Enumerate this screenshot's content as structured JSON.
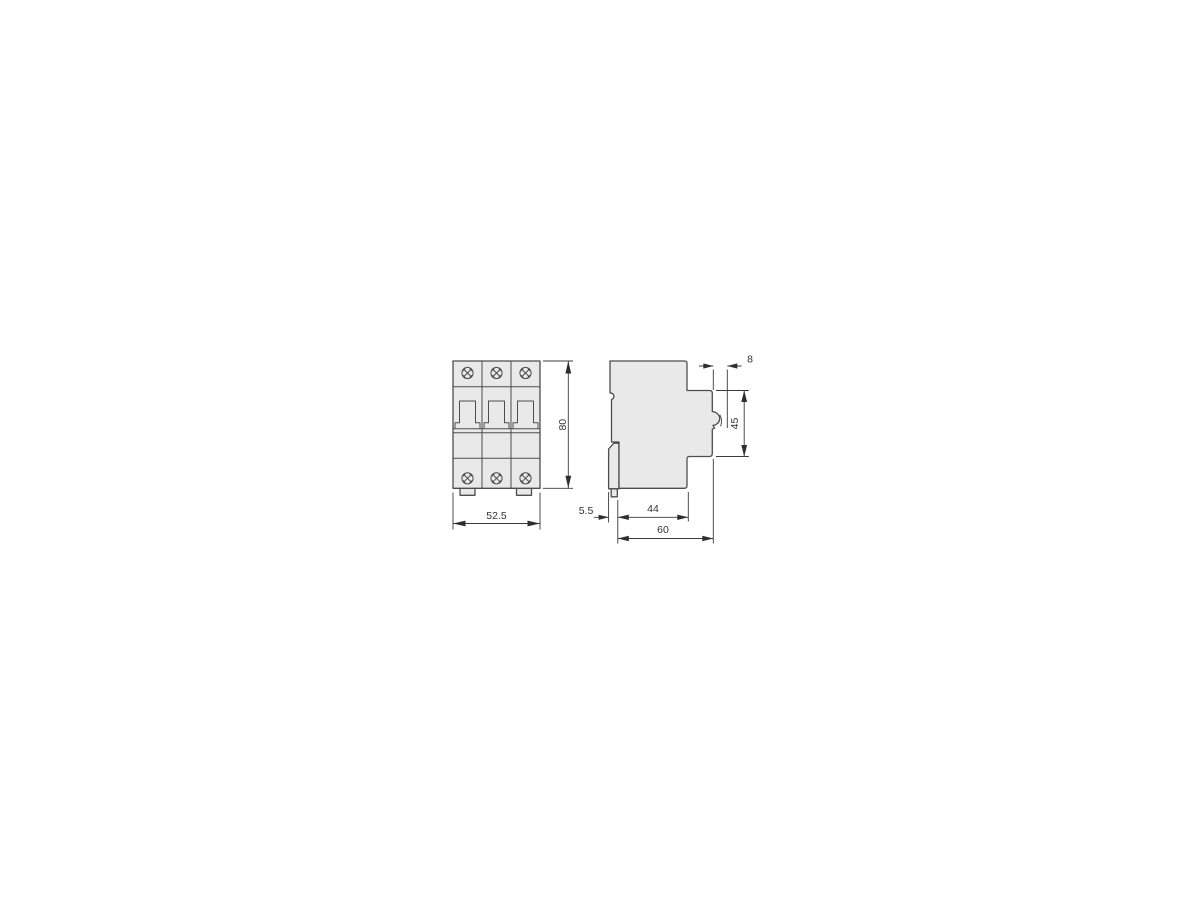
{
  "drawing": {
    "type": "technical-dimension-drawing",
    "views": {
      "front": {
        "pole_count": 3,
        "dimensions": {
          "width": "52.5",
          "height": "80"
        }
      },
      "side": {
        "dimensions": {
          "back_clip_depth": "5.5",
          "body_depth": "44",
          "total_depth": "60",
          "front_section_height": "45",
          "handle_projection": "8"
        }
      }
    },
    "colors": {
      "background": "#ffffff",
      "body_fill": "#e9e9e9",
      "outline": "#4d4d4d",
      "dimension_lines": "#3a3a3a",
      "text": "#333333"
    }
  }
}
